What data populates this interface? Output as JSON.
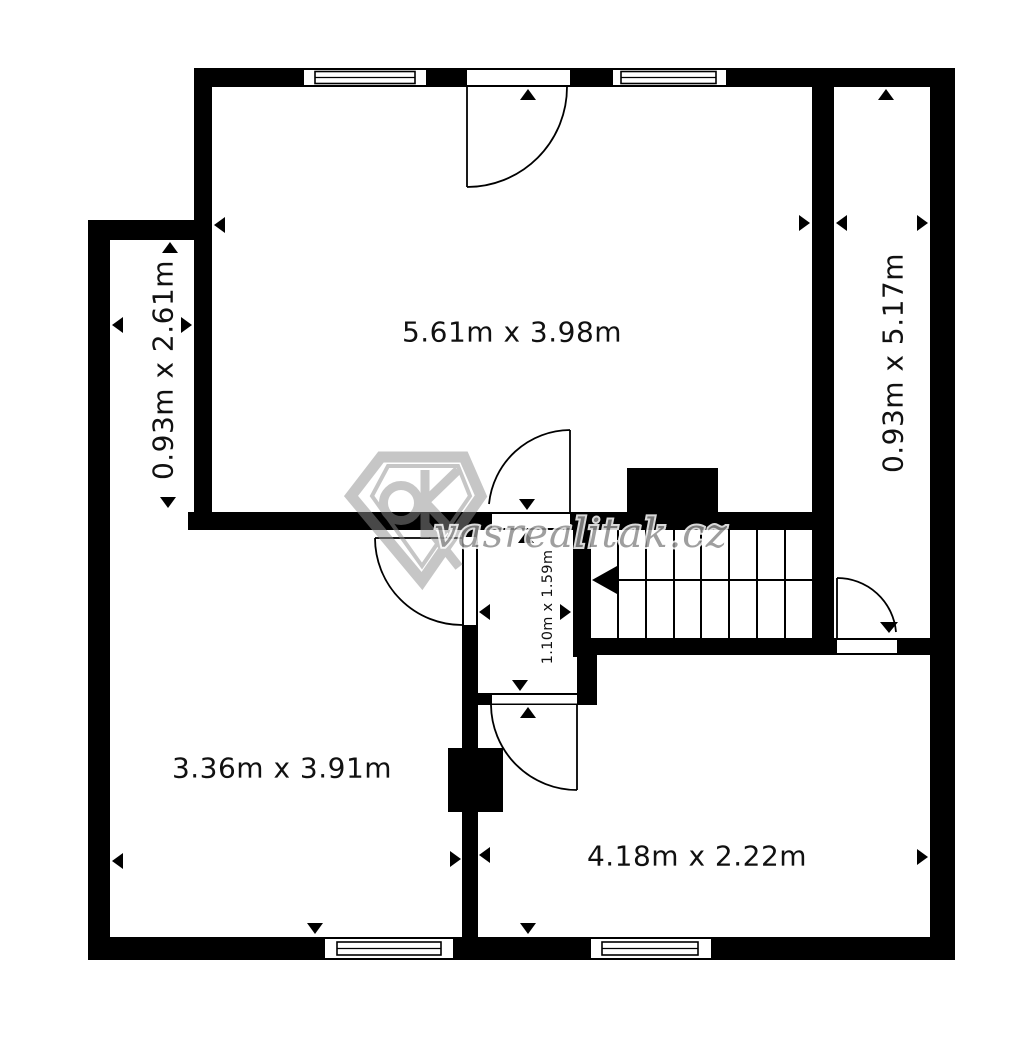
{
  "plan": {
    "type": "floor-plan",
    "rooms": {
      "top": {
        "label": "5.61m x 3.98m"
      },
      "left": {
        "label": "0.93m x 2.61m"
      },
      "right": {
        "label": "0.93m x 5.17m"
      },
      "bottom_left": {
        "label": "3.36m x 3.91m"
      },
      "bottom_right": {
        "label": "4.18m x 2.22m"
      },
      "hall": {
        "label": "1.10m x 1.59m"
      }
    },
    "stairs": {
      "steps": 8,
      "direction": "left"
    }
  },
  "watermark": {
    "brand": "vasrealitak.cz",
    "logo_monogram": "OK",
    "color": "#8f8f8f"
  },
  "colors": {
    "wall": "#000000",
    "background": "#ffffff",
    "label_text": "#111111"
  }
}
